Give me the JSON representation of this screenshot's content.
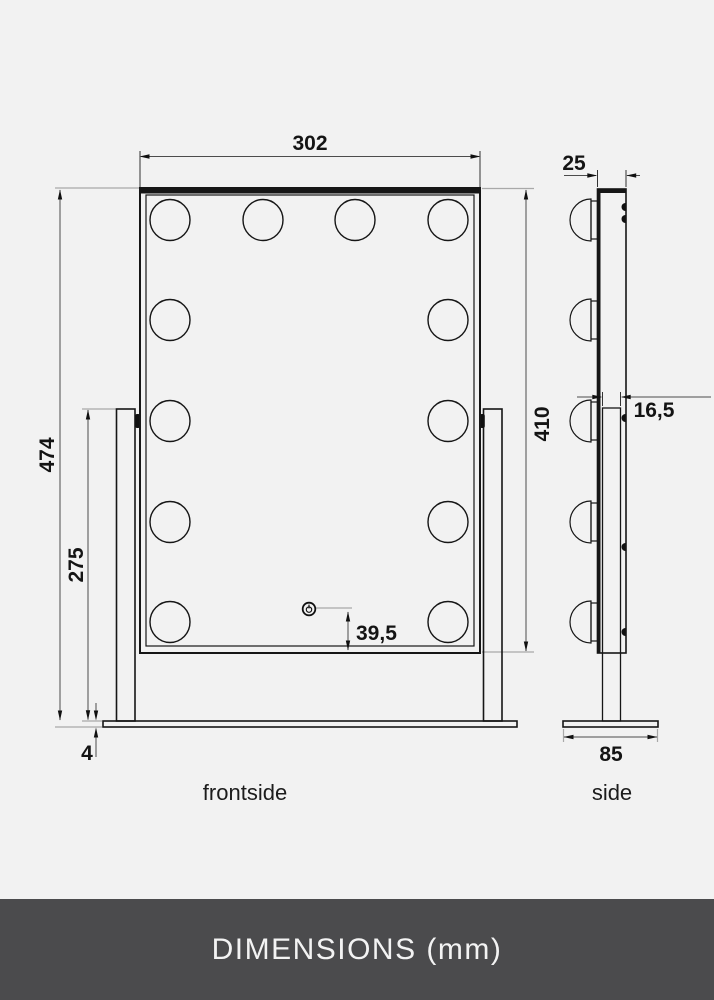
{
  "footer": {
    "label": "DIMENSIONS (mm)"
  },
  "views": {
    "front": {
      "label": "frontside"
    },
    "side": {
      "label": "side"
    }
  },
  "dims": {
    "mirror_width": "302",
    "total_height": "474",
    "stand_height": "275",
    "mirror_height": "410",
    "depth": "25",
    "stand_thickness": "16,5",
    "button_offset": "39,5",
    "base_thickness": "4",
    "base_depth": "85"
  },
  "icons": {
    "power_button": "power-icon",
    "light_bulb": "bulb-icon"
  },
  "colors": {
    "background": "#f2f2f2",
    "drawing_line": "#161616",
    "dimension_line": "#4c4c4c",
    "extension_line": "#a9a9a9",
    "footer_background": "#4b4b4d",
    "footer_text": "#f3f3f3"
  }
}
